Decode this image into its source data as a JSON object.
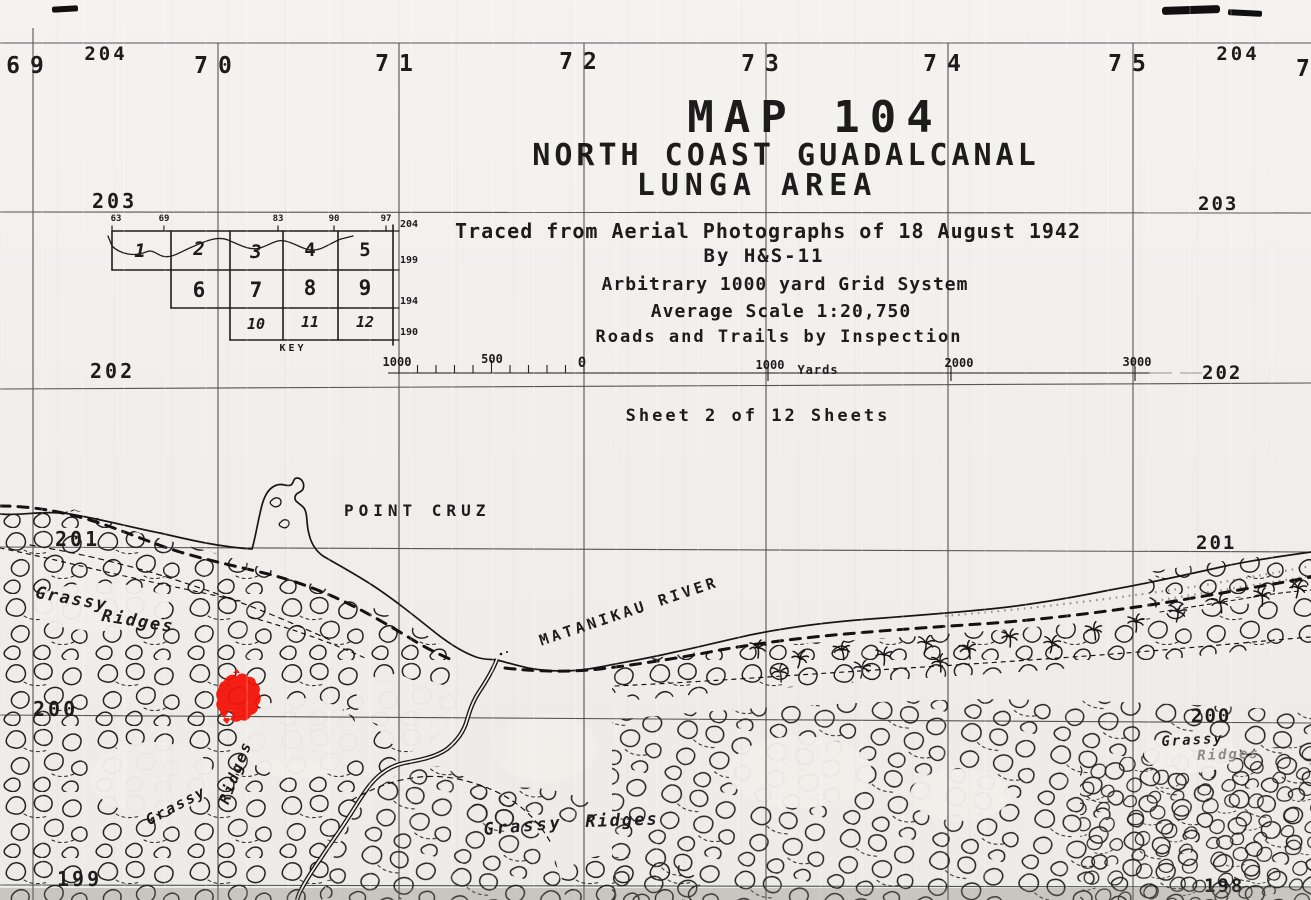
{
  "title_block": {
    "map_number": "MAP 104",
    "title_line1": "NORTH COAST GUADALCANAL",
    "title_line2": "LUNGA AREA",
    "source_line1": "Traced from Aerial Photographs of 18 August 1942",
    "source_line2": "By H&S-11",
    "source_line3": "Arbitrary 1000 yard Grid System",
    "source_line4": "Average Scale 1:20,750",
    "source_line5": "Roads and Trails by Inspection",
    "sheet_note": "Sheet 2 of 12 Sheets"
  },
  "grid_labels": {
    "top": [
      "69",
      "70",
      "71",
      "72",
      "73",
      "74",
      "75",
      "7"
    ],
    "top_left_northing": "204",
    "top_right_northing": "204",
    "left": [
      "203",
      "202",
      "201",
      "200",
      "199"
    ],
    "right": [
      "203",
      "202",
      "201",
      "200",
      "198"
    ]
  },
  "key_index": {
    "caption": "KEY",
    "row1": [
      "1",
      "2",
      "3",
      "4",
      "5"
    ],
    "row2": [
      "6",
      "7",
      "8",
      "9"
    ],
    "row3": [
      "10",
      "11",
      "12"
    ],
    "top_ticks": [
      "63",
      "69",
      "83",
      "90",
      "97"
    ],
    "right_ticks": [
      "204",
      "199",
      "194",
      "190"
    ]
  },
  "scale_bar": {
    "left_label": "1000",
    "mid_label": "500",
    "zero_label": "0",
    "right_labels": [
      "1000",
      "2000",
      "3000"
    ],
    "unit": "Yards"
  },
  "feature_labels": {
    "point_cruz": "POINT CRUZ",
    "matanikau_river": "MATANIKAU RIVER",
    "grassy_nw_1": "Grassy",
    "grassy_nw_2": "Ridges",
    "ridges_w": "Ridges",
    "grassy_w": "Grassy",
    "grassy_c": "Grassy",
    "ridges_c": "Ridges",
    "grassy_e": "Grassy",
    "ridges_e": "Ridges"
  },
  "colors": {
    "ink": "#1c1c1c",
    "paper": "#f1efec",
    "stamp_red": "#f31408"
  }
}
